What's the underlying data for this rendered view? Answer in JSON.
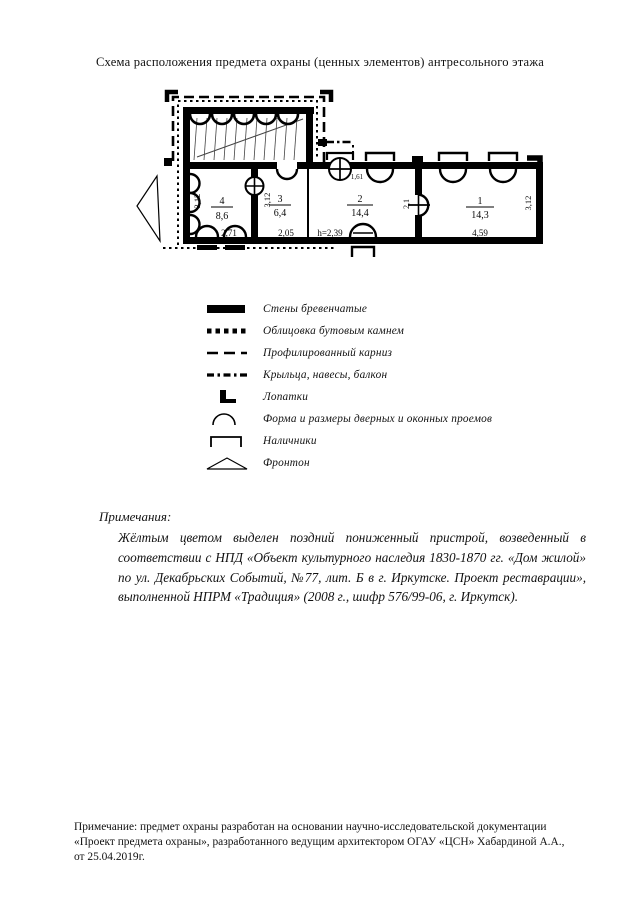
{
  "title": "Схема расположения предмета охраны (ценных элементов) антресольного этажа",
  "plan": {
    "rooms": [
      {
        "number": "1",
        "area": "14,3"
      },
      {
        "number": "2",
        "area": "14,4"
      },
      {
        "number": "3",
        "area": "6,4"
      },
      {
        "number": "4",
        "area": "8,6"
      }
    ],
    "dims": {
      "room1_width": "4,59",
      "room2_height": "h=2,39",
      "room3_width": "2,05",
      "room4_width": "2,71",
      "room1_depth": "3,12",
      "room3_depth": "3,12",
      "room4_depth": "3,12",
      "door_width": "2,1",
      "window_width": "1,61"
    }
  },
  "legend": {
    "items": [
      {
        "symbol": "log-walls",
        "label": "Стены бревенчатые"
      },
      {
        "symbol": "rubble-stone-facing",
        "label": "Облицовка бутовым камнем"
      },
      {
        "symbol": "profiled-cornice",
        "label": "Профилированный карниз"
      },
      {
        "symbol": "porches-canopies-balcony",
        "label": "Крыльца, навесы, балкон"
      },
      {
        "symbol": "pilaster-strips",
        "label": "Лопатки"
      },
      {
        "symbol": "door-window-openings",
        "label": "Форма и размеры дверных и оконных проемов"
      },
      {
        "symbol": "window-casings",
        "label": "Наличники"
      },
      {
        "symbol": "pediment",
        "label": "Фронтон"
      }
    ]
  },
  "notes": {
    "heading": "Примечания:",
    "body": "Жёлтым цветом выделен поздний пониженный пристрой, возведенный в соответствии с НПД «Объект культурного наследия 1830-1870 гг. «Дом жилой» по ул. Декабрьских Событий, №77, лит. Б в г. Иркутске. Проект реставрации», выполненной НПРМ «Традиция» (2008 г., шифр 576/99-06, г. Иркутск)."
  },
  "footer": {
    "note": "Примечание: предмет охраны разработан на основании научно-исследовательской документации «Проект предмета охраны», разработанного ведущим архитектором ОГАУ «ЦСН»  Хабардиной А.А., от 25.04.2019г."
  }
}
